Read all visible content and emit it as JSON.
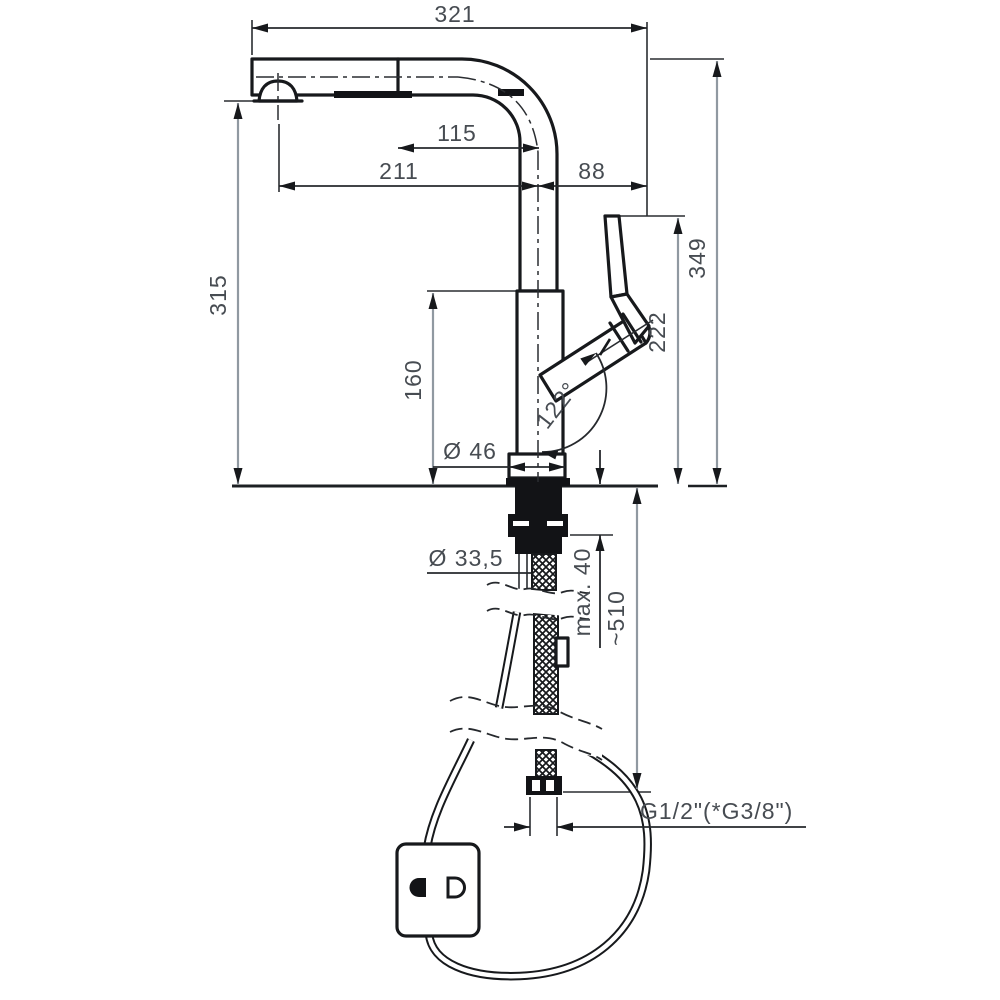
{
  "drawing": {
    "subject": "pull-out kitchen faucet dimensional drawing",
    "background_color": "#ffffff",
    "object_line_color": "#17191c",
    "dimension_shaft_color": "#9099a1",
    "dimension_text_color": "#474c52",
    "labels": {
      "total_reach": "321",
      "head_reach": "115",
      "spout_reach": "211",
      "handle_offset": "88",
      "spout_height": "315",
      "body_height": "160",
      "handle_height": "222",
      "total_height": "349",
      "base_diameter": "Ø 46",
      "handle_angle": "122°",
      "hole_diameter": "Ø 33,5",
      "max_counter_thickness": "max. 40",
      "hose_length": "~510",
      "thread_size": "G1/2\"(*G3/8\")"
    }
  }
}
